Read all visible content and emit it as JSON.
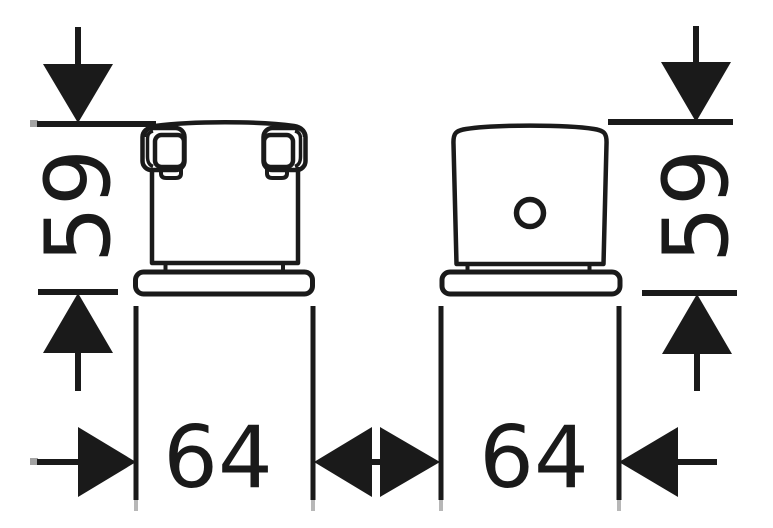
{
  "diagram": {
    "type": "technical-dimension-drawing",
    "background_color": "#ffffff",
    "line_color": "#1a1a1a",
    "dimensions": {
      "front_height": "59",
      "front_width": "64",
      "side_height": "59",
      "side_width": "64"
    }
  }
}
